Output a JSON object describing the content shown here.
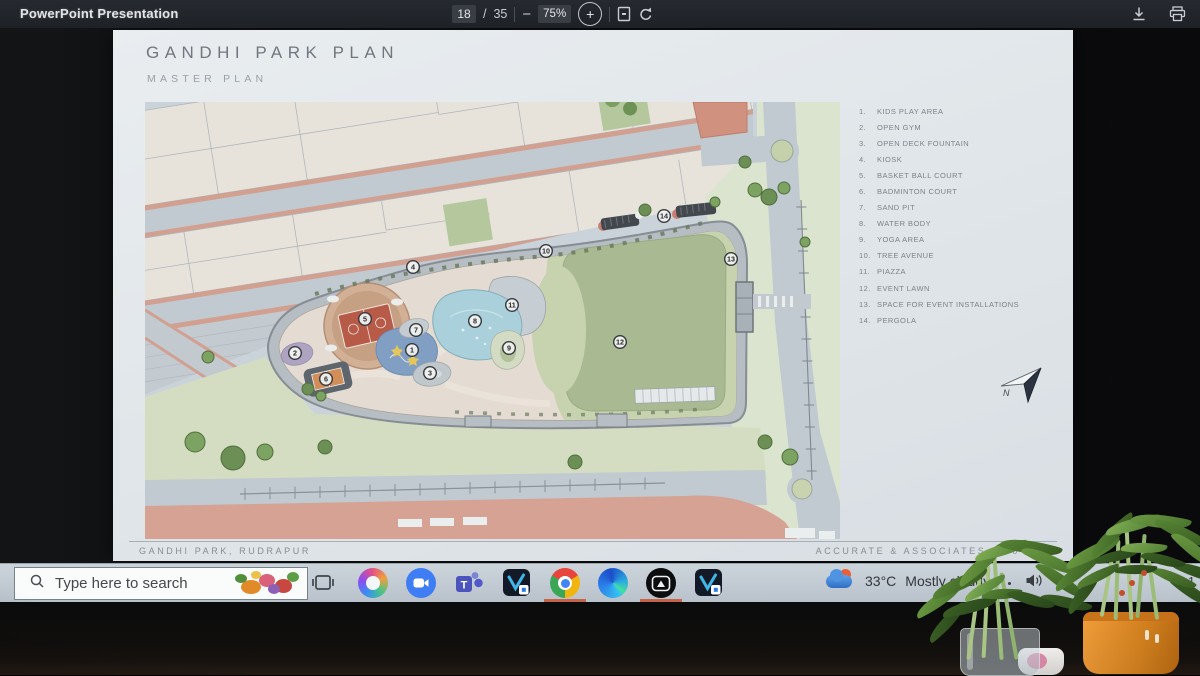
{
  "viewer_toolbar": {
    "title": "PowerPoint Presentation",
    "page_current": "18",
    "page_separator": "/",
    "page_total": "35",
    "minus_glyph": "−",
    "zoom_level": "75%",
    "plus_glyph": "+",
    "icons": [
      "fit-page-icon",
      "rotate-icon",
      "download-icon",
      "print-icon"
    ]
  },
  "slide": {
    "title": "GANDHI PARK PLAN",
    "subtitle": "MASTER PLAN",
    "north_label": "N",
    "footer_left": "GANDHI PARK, RUDRAPUR",
    "footer_right": "ACCURATE & ASSOCIATES",
    "footer_right_suffix": "0",
    "legend": [
      {
        "n": "1",
        "label": "KIDS PLAY AREA"
      },
      {
        "n": "2",
        "label": "OPEN GYM"
      },
      {
        "n": "3",
        "label": "OPEN DECK FOUNTAIN"
      },
      {
        "n": "4",
        "label": "KIOSK"
      },
      {
        "n": "5",
        "label": "BASKET BALL COURT"
      },
      {
        "n": "6",
        "label": "BADMINTON COURT"
      },
      {
        "n": "7",
        "label": "SAND PIT"
      },
      {
        "n": "8",
        "label": "WATER BODY"
      },
      {
        "n": "9",
        "label": "YOGA AREA"
      },
      {
        "n": "10",
        "label": "TREE AVENUE"
      },
      {
        "n": "11",
        "label": "PIAZZA"
      },
      {
        "n": "12",
        "label": "EVENT LAWN"
      },
      {
        "n": "13",
        "label": "SPACE FOR EVENT INSTALLATIONS"
      },
      {
        "n": "14",
        "label": "PERGOLA"
      }
    ],
    "plan_markers": [
      {
        "n": "1",
        "x": 267,
        "y": 248
      },
      {
        "n": "2",
        "x": 150,
        "y": 251
      },
      {
        "n": "3",
        "x": 285,
        "y": 271
      },
      {
        "n": "4",
        "x": 268,
        "y": 165
      },
      {
        "n": "5",
        "x": 220,
        "y": 217
      },
      {
        "n": "6",
        "x": 181,
        "y": 277
      },
      {
        "n": "7",
        "x": 271,
        "y": 228
      },
      {
        "n": "8",
        "x": 330,
        "y": 219
      },
      {
        "n": "9",
        "x": 364,
        "y": 246
      },
      {
        "n": "10",
        "x": 401,
        "y": 149
      },
      {
        "n": "11",
        "x": 367,
        "y": 203
      },
      {
        "n": "12",
        "x": 475,
        "y": 240
      },
      {
        "n": "13",
        "x": 586,
        "y": 157
      },
      {
        "n": "14",
        "x": 519,
        "y": 114
      }
    ]
  },
  "taskbar": {
    "search_placeholder": "Type here to search",
    "apps": [
      "task-view",
      "copilot",
      "zoom",
      "teams",
      "pinned-dev-app",
      "chrome",
      "edge",
      "capture-app",
      "pinned-dev-app"
    ],
    "weather_temp": "33°C",
    "weather_desc": "Mostly cloudy",
    "tray_language": "E",
    "tray_time": "1"
  },
  "colors": {
    "accent_road": "#d8a18e",
    "lawn_green": "#a9bc90",
    "water_blue": "#a8d3df",
    "court_red": "#bf5843",
    "taskbar": "#c3ccd4",
    "toolbar": "#22252b"
  }
}
